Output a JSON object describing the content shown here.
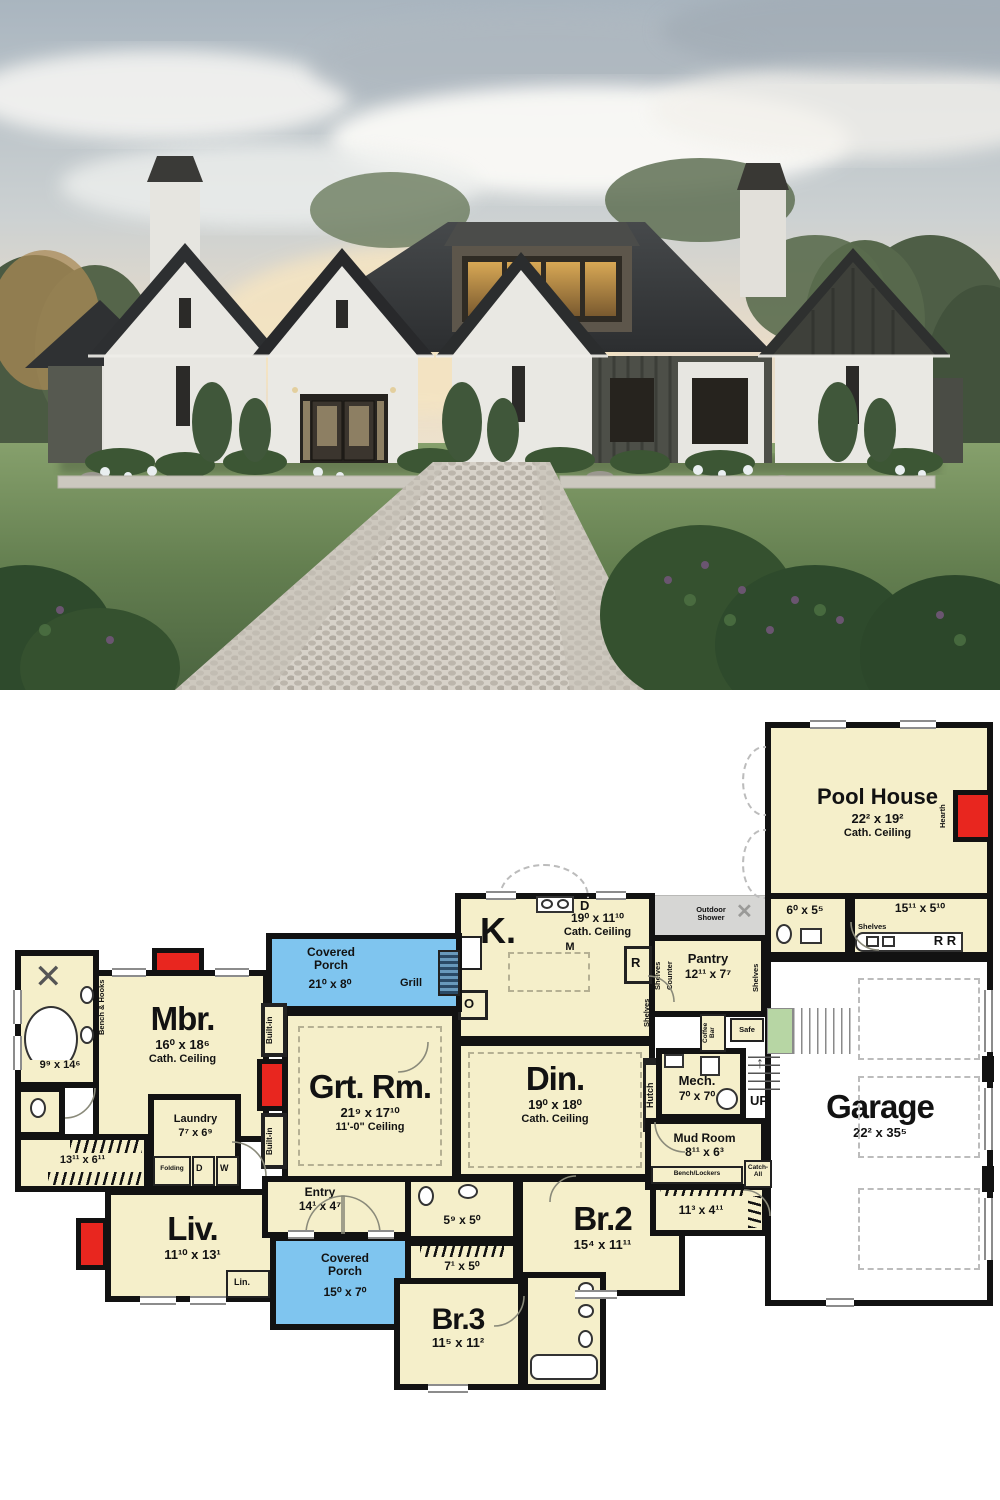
{
  "colors": {
    "plan_cream": "#f5efca",
    "porch_blue": "#7fc5ef",
    "fireplace_red": "#e8261f",
    "shower_gray": "#d6d6d4",
    "stair_green": "#b7d6a4",
    "wall_black": "#121212",
    "roof_charcoal": "#333537",
    "brick_white": "#e8e7e2",
    "lawn_green": "#6d8b59"
  },
  "plan": {
    "pool_house": {
      "name": "Pool House",
      "dims": "22² x 19²",
      "ceiling": "Cath. Ceiling",
      "hearth": "Hearth"
    },
    "pool_bath": {
      "dims": "6⁰ x 5⁵"
    },
    "pool_hall": {
      "dims": "15¹¹ x 5¹⁰",
      "shelves": "Shelves",
      "fridges": "R   R"
    },
    "outdoor_shower": {
      "label": "Outdoor Shower"
    },
    "garage": {
      "name": "Garage",
      "dims": "22² x 35⁵"
    },
    "pantry": {
      "name": "Pantry",
      "dims": "12¹¹ x 7⁷",
      "shelves_left": "Shelves",
      "counter": "Counter",
      "shelves_right": "Shelves"
    },
    "kitchen": {
      "name": "K.",
      "dims": "19⁰ x 11¹⁰",
      "ceiling": "Cath. Ceiling",
      "microwave": "M",
      "dishwasher": "D",
      "oven": "O",
      "fridge": "R",
      "shelves": "Shelves"
    },
    "porch_top": {
      "name": "Covered Porch",
      "dims": "21⁰ x 8⁰",
      "grill": "Grill"
    },
    "mbr": {
      "name": "Mbr.",
      "dims": "16⁰ x 18⁶",
      "ceiling": "Cath. Ceiling",
      "bench": "Bench & Hooks"
    },
    "builtins": {
      "top": "Built-in",
      "bottom": "Built-in"
    },
    "grt": {
      "name": "Grt. Rm.",
      "dims": "21⁹ x 17¹⁰",
      "ceiling": "11'-0\" Ceiling"
    },
    "din": {
      "name": "Din.",
      "dims": "19⁰ x 18⁰",
      "ceiling": "Cath. Ceiling",
      "hutch": "Hutch"
    },
    "mbath": {
      "dims": "9⁹ x 14⁶"
    },
    "closet13": {
      "dims": "13¹¹ x 6¹¹"
    },
    "laundry": {
      "name": "Laundry",
      "dims": "7⁷ x 6⁹",
      "folding": "Folding",
      "dryer": "D",
      "washer": "W"
    },
    "liv": {
      "name": "Liv.",
      "dims": "11¹⁰ x 13¹",
      "linen": "Lin."
    },
    "entry": {
      "name": "Entry",
      "dims": "14¹ x 4⁷"
    },
    "porch_bottom": {
      "name": "Covered Porch",
      "dims": "15⁰ x 7⁰"
    },
    "hall_bath": {
      "dims": "5⁹ x 5⁰"
    },
    "hall_closet": {
      "dims": "7¹ x 5⁰"
    },
    "br2": {
      "name": "Br.2",
      "dims": "15⁴ x 11¹¹"
    },
    "br2_closet": {
      "dims": "11³ x 4¹¹"
    },
    "br3": {
      "name": "Br.3",
      "dims": "11⁵ x 11²"
    },
    "mud": {
      "name": "Mud Room",
      "dims": "8¹¹ x 6³",
      "bench": "Bench/Lockers",
      "catch": "Catch-All"
    },
    "mech": {
      "name": "Mech.",
      "dims": "7⁰ x 7⁰"
    },
    "stair": {
      "up": "UP"
    },
    "coffee_bar": "Coffee Bar",
    "safe": "Safe"
  }
}
